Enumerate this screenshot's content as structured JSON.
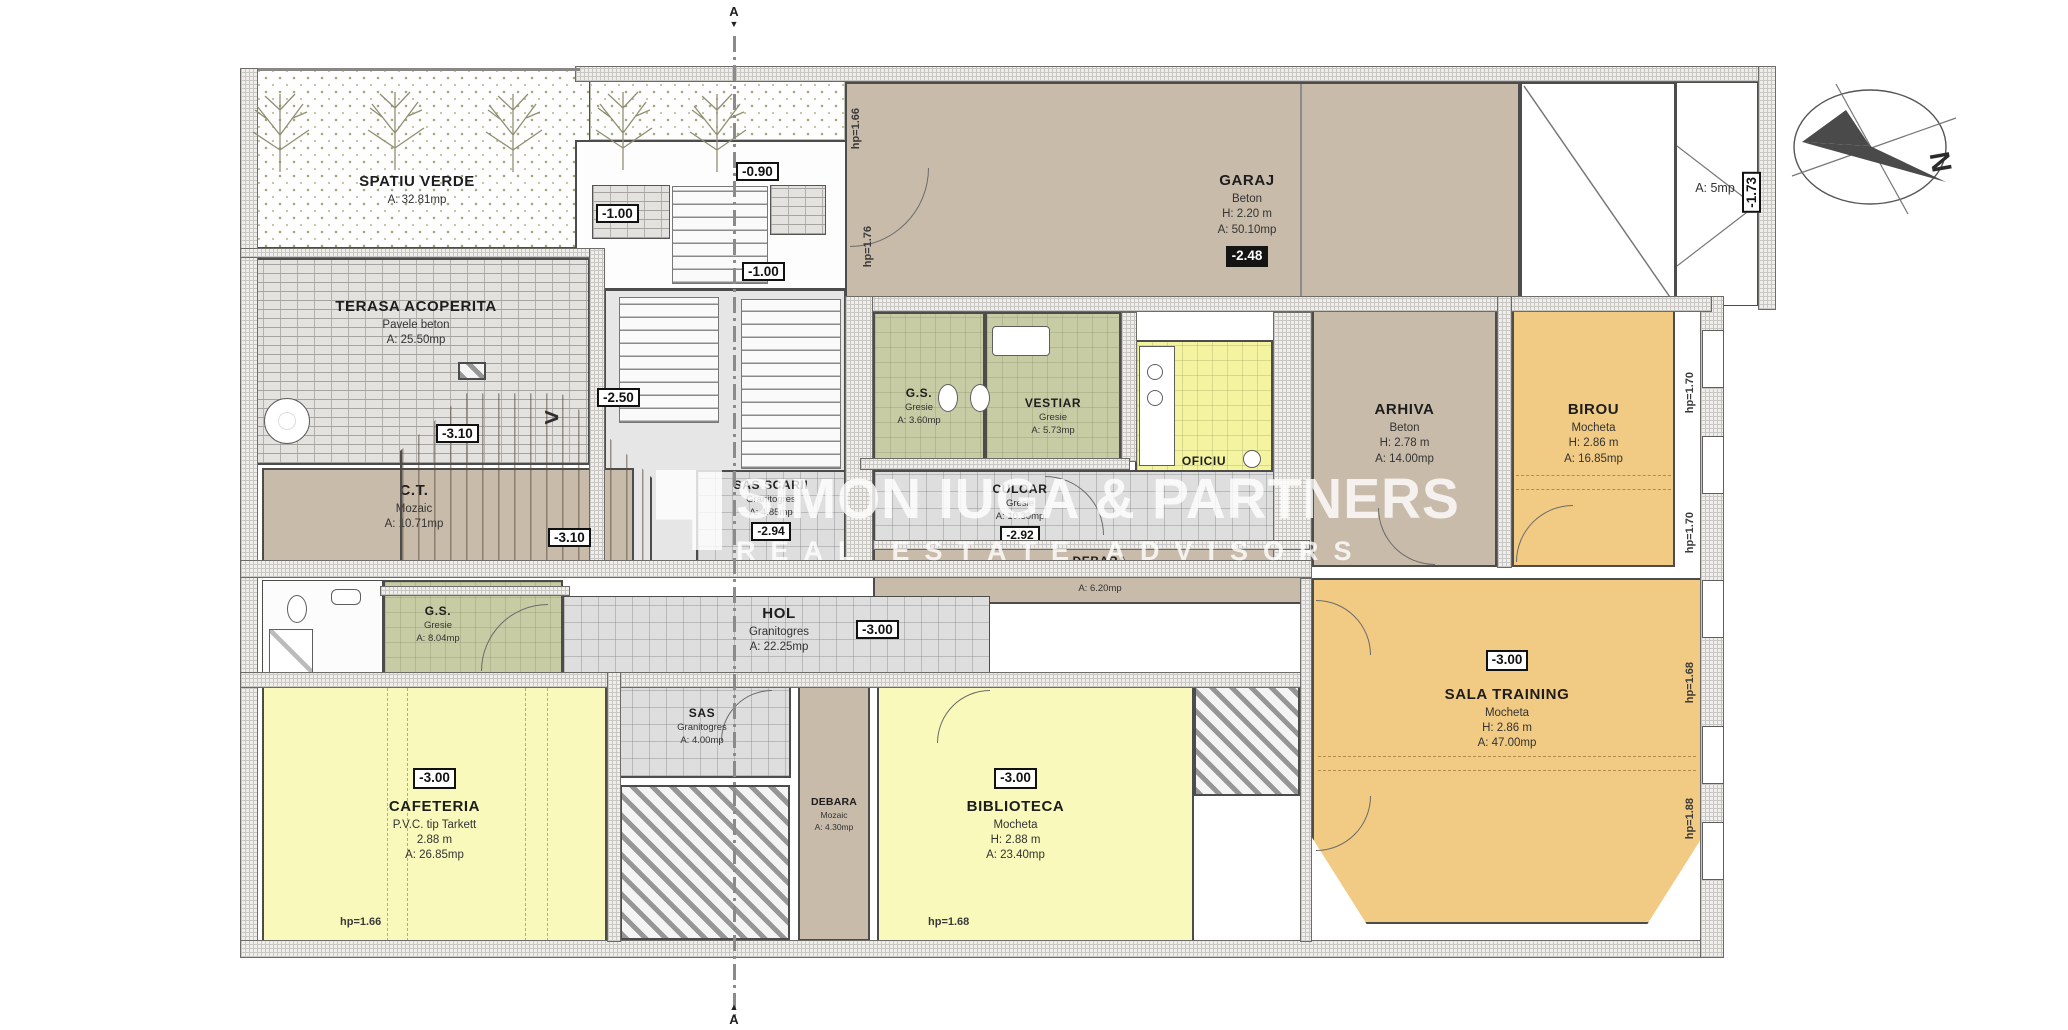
{
  "watermark": {
    "line1": "SIMON IUGA & PARTNERS",
    "line2": "REAL ESTATE ADVISORS"
  },
  "compass": {
    "north": "N"
  },
  "section": {
    "label": "A"
  },
  "palette": {
    "tan": "#c8bbaa",
    "orange": "#f1ca83",
    "pale_yellow": "#f9f9bb",
    "kitchen_yellow": "#f4f4a0",
    "gresie_green": "#c7cca4",
    "granitogres_gray": "#dedede"
  },
  "rooms": {
    "spatiu_verde": {
      "name": "SPATIU VERDE",
      "area": "A: 32.81mp"
    },
    "terasa": {
      "name": "TERASA ACOPERITA",
      "finish": "Pavele beton",
      "area": "A: 25.50mp"
    },
    "garaj": {
      "name": "GARAJ",
      "finish": "Beton",
      "height": "H: 2.20 m",
      "area": "A: 50.10mp",
      "level": "-2.48"
    },
    "storage_right": {
      "area": "A: 5mp",
      "level": "-1.73"
    },
    "arhiva": {
      "name": "ARHIVA",
      "finish": "Beton",
      "height": "H: 2.78 m",
      "area": "A: 14.00mp"
    },
    "birou": {
      "name": "BIROU",
      "finish": "Mocheta",
      "height": "H: 2.86 m",
      "area": "A: 16.85mp"
    },
    "ct": {
      "name": "C.T.",
      "finish": "Mozaic",
      "area": "A: 10.71mp"
    },
    "gs_top": {
      "name": "G.S.",
      "finish": "Gresie",
      "area": "A: 3.60mp"
    },
    "vestiar": {
      "name": "VESTIAR",
      "finish": "Gresie",
      "area": "A: 5.73mp"
    },
    "oficiu": {
      "name": "OFICIU",
      "finish": "Gresie",
      "height": "H: 2.82 m",
      "area": "A: 7.84mp"
    },
    "culoar": {
      "name": "CULOAR",
      "finish": "Gresie",
      "area": "A: 10.30mp",
      "level": "-2.92"
    },
    "sas_scarii": {
      "name": "SAS SCARII",
      "finish": "Granitogres",
      "area": "A: 4.85mp",
      "level": "-2.94"
    },
    "debara_mid": {
      "name": "DEBARA",
      "finish": "Mozaic",
      "area": "A: 6.20mp"
    },
    "hol": {
      "name": "HOL",
      "finish": "Granitogres",
      "area": "A: 22.25mp",
      "level": "-3.00"
    },
    "gs_left": {
      "name": "G.S.",
      "finish": "Gresie",
      "area": "A: 8.04mp"
    },
    "sas": {
      "name": "SAS",
      "finish": "Granitogres",
      "area": "A: 4.00mp"
    },
    "cafeteria": {
      "name": "CAFETERIA",
      "finish": "P.V.C. tip Tarkett",
      "height": "2.88 m",
      "area": "A: 26.85mp",
      "level": "-3.00"
    },
    "debara_small": {
      "name": "DEBARA",
      "finish": "Mozaic",
      "area": "A: 4.30mp"
    },
    "biblioteca": {
      "name": "BIBLIOTECA",
      "finish": "Mocheta",
      "height": "H: 2.88 m",
      "area": "A: 23.40mp",
      "level": "-3.00"
    },
    "sala_training": {
      "name": "SALA TRAINING",
      "finish": "Mocheta",
      "height": "H: 2.86 m",
      "area": "A: 47.00mp",
      "level": "-3.00"
    }
  },
  "levels": {
    "entry": "-0.90",
    "landing_upper": "-1.00",
    "landing_lower": "-1.00",
    "stair_mid": "-2.50",
    "stair_low": "-3.10",
    "ct_right": "-3.10"
  },
  "annotations": {
    "hp_garage_top": "hp=1.66",
    "hp_garage_mid": "hp=1.76",
    "hp_right_1": "hp=1.70",
    "hp_right_2": "hp=1.70",
    "hp_right_3": "hp=1.68",
    "hp_right_4": "hp=1.88",
    "hp_bottom_left": "hp=1.66",
    "hp_bottom_mid": "hp=1.68"
  }
}
